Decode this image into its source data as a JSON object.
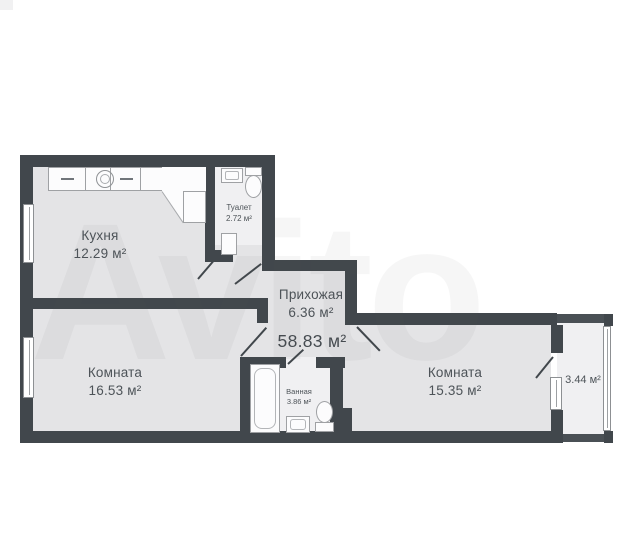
{
  "plan": {
    "total_area": "58.83 м²",
    "rooms": {
      "kitchen": {
        "name": "Кухня",
        "area": "12.29 м²"
      },
      "toilet": {
        "name": "Туалет",
        "area": "2.72 м²"
      },
      "hallway": {
        "name": "Прихожая",
        "area": "6.36 м²"
      },
      "room_left": {
        "name": "Комната",
        "area": "16.53 м²"
      },
      "bathroom": {
        "name": "Ванная",
        "area": "3.86 м²"
      },
      "room_right": {
        "name": "Комната",
        "area": "15.35 м²"
      },
      "balcony": {
        "area": "3.44 м²"
      }
    },
    "watermark": "Avito",
    "colors": {
      "wall": "#41474c",
      "floor": "#e4e4e6",
      "floor_wet": "#f0f0f2",
      "label_text": "#4d5358",
      "background": "#ffffff"
    }
  }
}
